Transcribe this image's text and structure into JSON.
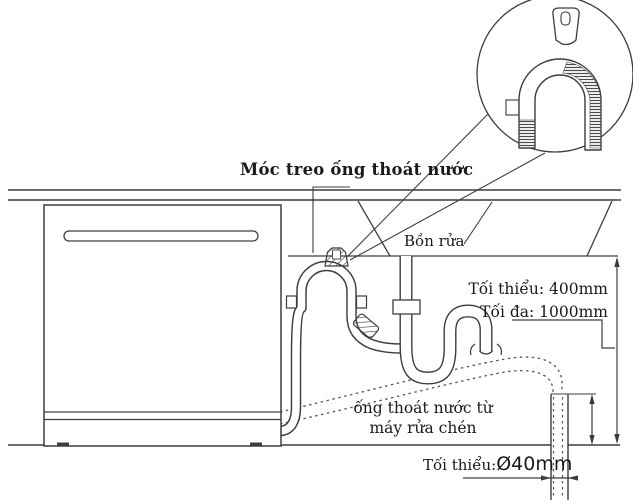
{
  "diagram": {
    "title_label": "Móc treo ống thoát nước",
    "sink_label": "Bồn rửa",
    "dim_min_label": "Tối thiểu: 400mm",
    "dim_max_label": "Tối đa: 1000mm",
    "hose_label_line1": "ống thoát nước từ",
    "hose_label_line2": "máy rửa chén",
    "diameter_prefix": "Tối thiểu:",
    "diameter_value": "Ø40mm",
    "colors": {
      "line": "#3d3d3d",
      "text": "#1a1a1a",
      "background": "#ffffff",
      "hatch": "#4a4a4a"
    }
  }
}
